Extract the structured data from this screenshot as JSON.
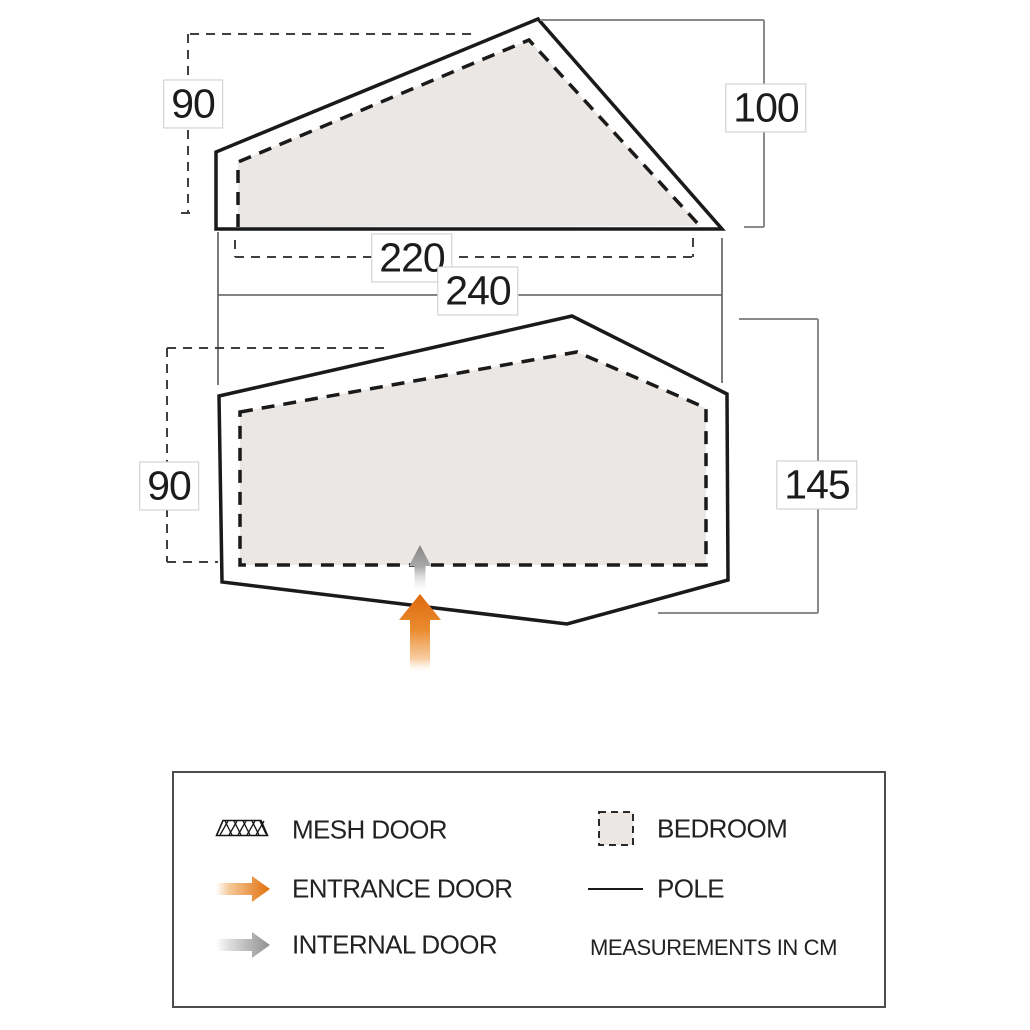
{
  "diagram": {
    "units_note": "MEASUREMENTS IN CM",
    "side_view": {
      "name": "tent side elevation",
      "height_left": "90",
      "height_right": "100",
      "width_inner": "220",
      "width_outer": "240"
    },
    "floor_plan": {
      "name": "tent floor plan",
      "depth_left": "90",
      "depth_right": "145",
      "features": [
        {
          "icon": "entrance-door-arrow-icon",
          "meaning": "entrance door"
        },
        {
          "icon": "internal-door-arrow-icon",
          "meaning": "internal door"
        },
        {
          "icon": "bedroom-area",
          "meaning": "bedroom"
        }
      ]
    }
  },
  "legend": {
    "items": [
      {
        "icon": "mesh-door-icon",
        "label": "MESH DOOR"
      },
      {
        "icon": "entrance-door-arrow-icon",
        "label": "ENTRANCE DOOR"
      },
      {
        "icon": "internal-door-arrow-icon",
        "label": "INTERNAL DOOR"
      },
      {
        "icon": "bedroom-swatch-icon",
        "label": "BEDROOM"
      },
      {
        "icon": "pole-line-icon",
        "label": "POLE"
      }
    ],
    "note": "MEASUREMENTS IN CM"
  },
  "colors": {
    "outline": "#1a1a1a",
    "bedroom_fill": "#eae7e4",
    "dimension_gray": "#8a8a8a",
    "entrance_orange": "#e2700c",
    "internal_gray": "#909090"
  }
}
